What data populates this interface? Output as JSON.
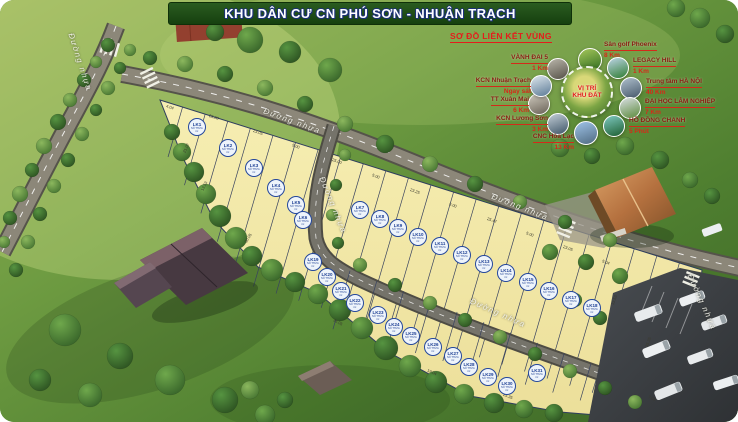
{
  "title": "KHU DÂN CƯ CN PHÚ SƠN - NHUẬN TRẠCH",
  "roads": {
    "label": "Đường nhựa",
    "instances": [
      {
        "x": 80,
        "y": 62,
        "rot": 72
      },
      {
        "x": 292,
        "y": 121,
        "rot": 20
      },
      {
        "x": 520,
        "y": 207,
        "rot": 21
      },
      {
        "x": 333,
        "y": 205,
        "rot": 68
      },
      {
        "x": 498,
        "y": 313,
        "rot": 24
      },
      {
        "x": 702,
        "y": 302,
        "rot": 66
      }
    ]
  },
  "inset": {
    "title": "SƠ ĐỒ LIÊN KẾT VÙNG",
    "center": {
      "line1": "VỊ TRÍ",
      "line2": "KHU ĐẤT",
      "cx": 587,
      "cy": 92,
      "r": 26
    },
    "items": [
      {
        "name": "Sân golf Phoenix",
        "distance": "8 Km",
        "cx": 590,
        "cy": 60,
        "r": 12,
        "lx": 604,
        "ly": 41,
        "lw": 86,
        "align": "left",
        "g1": "#a5c75a",
        "g2": "#2e6b1f",
        "icon": "golf-course-photo"
      },
      {
        "name": "LEGACY HILL",
        "distance": "1 Km",
        "cx": 618,
        "cy": 68,
        "r": 11,
        "lx": 633,
        "ly": 57,
        "lw": 72,
        "align": "left",
        "g1": "#bcd4e6",
        "g2": "#2f7d32",
        "icon": "legacy-hill-photo"
      },
      {
        "name": "Trung tâm HÀ NỘI",
        "distance": "40 Km",
        "cx": 631,
        "cy": 88,
        "r": 11,
        "lx": 646,
        "ly": 78,
        "lw": 88,
        "align": "left",
        "g1": "#aebfcc",
        "g2": "#46586a",
        "icon": "hanoi-skyline-photo"
      },
      {
        "name": "ĐẠI HỌC LÂM NGHIỆP",
        "distance": "7 Km",
        "cx": 630,
        "cy": 108,
        "r": 11,
        "lx": 645,
        "ly": 98,
        "lw": 95,
        "align": "left",
        "g1": "#d8dee2",
        "g2": "#5a8a3a",
        "icon": "university-photo"
      },
      {
        "name": "HỒ ĐỒNG CHANH",
        "distance": "5 Phút",
        "cx": 614,
        "cy": 126,
        "r": 11,
        "lx": 629,
        "ly": 117,
        "lw": 82,
        "align": "left",
        "g1": "#7ec8c0",
        "g2": "#1d5e30",
        "icon": "lake-photo"
      },
      {
        "name": "CNC Hòa Lạc",
        "distance": "13 Km",
        "cx": 586,
        "cy": 133,
        "r": 12,
        "lx": 508,
        "ly": 133,
        "lw": 66,
        "align": "right",
        "g1": "#9fc3e8",
        "g2": "#4f6a80",
        "icon": "hoa-lac-photo"
      },
      {
        "name": "KCN Lương Sơn",
        "distance": "3 Km",
        "cx": 558,
        "cy": 124,
        "r": 11,
        "lx": 478,
        "ly": 115,
        "lw": 70,
        "align": "right",
        "g1": "#c2cdd6",
        "g2": "#3f5668",
        "icon": "luong-son-industrial-photo"
      },
      {
        "name": "TT Xuân Mai",
        "distance": "6 Km",
        "cx": 539,
        "cy": 104,
        "r": 11,
        "lx": 459,
        "ly": 96,
        "lw": 70,
        "align": "right",
        "g1": "#cfcabe",
        "g2": "#6a6257",
        "icon": "xuan-mai-photo"
      },
      {
        "name": "KCN Nhuận Trạch",
        "distance": "Ngay sát",
        "cx": 541,
        "cy": 86,
        "r": 11,
        "lx": 461,
        "ly": 77,
        "lw": 70,
        "align": "right",
        "g1": "#dde6ec",
        "g2": "#5b7a96",
        "icon": "nhuan-trach-industrial-photo"
      },
      {
        "name": "VÀNH ĐAI 5",
        "distance": "1 Km",
        "cx": 558,
        "cy": 69,
        "r": 11,
        "lx": 478,
        "ly": 54,
        "lw": 70,
        "align": "right",
        "g1": "#b9b5aa",
        "g2": "#565248",
        "icon": "ring-road-5-photo"
      }
    ]
  },
  "plot_detail": {
    "line1": "SỐ THỬA",
    "line2": "m²"
  },
  "plots": [
    {
      "label": "LK1",
      "x": 197,
      "y": 127
    },
    {
      "label": "LK2",
      "x": 228,
      "y": 148
    },
    {
      "label": "LK3",
      "x": 254,
      "y": 168
    },
    {
      "label": "LK4",
      "x": 276,
      "y": 188
    },
    {
      "label": "LK5",
      "x": 296,
      "y": 205
    },
    {
      "label": "LK6",
      "x": 303,
      "y": 220
    },
    {
      "label": "LK7",
      "x": 360,
      "y": 210
    },
    {
      "label": "LK8",
      "x": 380,
      "y": 219
    },
    {
      "label": "LK9",
      "x": 398,
      "y": 228
    },
    {
      "label": "LK10",
      "x": 418,
      "y": 237
    },
    {
      "label": "LK11",
      "x": 440,
      "y": 246
    },
    {
      "label": "LK12",
      "x": 462,
      "y": 255
    },
    {
      "label": "LK13",
      "x": 484,
      "y": 264
    },
    {
      "label": "LK14",
      "x": 506,
      "y": 273
    },
    {
      "label": "LK15",
      "x": 528,
      "y": 282
    },
    {
      "label": "LK16",
      "x": 549,
      "y": 291
    },
    {
      "label": "LK17",
      "x": 571,
      "y": 300
    },
    {
      "label": "LK18",
      "x": 592,
      "y": 308
    },
    {
      "label": "LK19",
      "x": 313,
      "y": 262
    },
    {
      "label": "LK20",
      "x": 327,
      "y": 277
    },
    {
      "label": "LK21",
      "x": 341,
      "y": 291
    },
    {
      "label": "LK22",
      "x": 355,
      "y": 303
    },
    {
      "label": "LK23",
      "x": 378,
      "y": 315
    },
    {
      "label": "LK24",
      "x": 394,
      "y": 327
    },
    {
      "label": "LK25",
      "x": 411,
      "y": 336
    },
    {
      "label": "LK26",
      "x": 433,
      "y": 347
    },
    {
      "label": "LK27",
      "x": 453,
      "y": 356
    },
    {
      "label": "LK28",
      "x": 469,
      "y": 367
    },
    {
      "label": "LK29",
      "x": 488,
      "y": 377
    },
    {
      "label": "LK30",
      "x": 507,
      "y": 386
    },
    {
      "label": "LK31",
      "x": 537,
      "y": 373
    }
  ],
  "dims": [
    {
      "t": "4.04",
      "x": 170,
      "y": 107,
      "r": 18
    },
    {
      "t": "25.00",
      "x": 214,
      "y": 117,
      "r": 18
    },
    {
      "t": "23.05",
      "x": 258,
      "y": 132,
      "r": 19
    },
    {
      "t": "5.00",
      "x": 296,
      "y": 146,
      "r": 20
    },
    {
      "t": "25.00",
      "x": 337,
      "y": 161,
      "r": 20
    },
    {
      "t": "5.00",
      "x": 376,
      "y": 176,
      "r": 20
    },
    {
      "t": "23.25",
      "x": 415,
      "y": 191,
      "r": 20
    },
    {
      "t": "5.00",
      "x": 453,
      "y": 205,
      "r": 20
    },
    {
      "t": "25.47",
      "x": 492,
      "y": 220,
      "r": 20
    },
    {
      "t": "5.00",
      "x": 530,
      "y": 234,
      "r": 20
    },
    {
      "t": "23.05",
      "x": 568,
      "y": 248,
      "r": 20
    },
    {
      "t": "5.04",
      "x": 606,
      "y": 262,
      "r": 20
    },
    {
      "t": "21.07",
      "x": 186,
      "y": 148,
      "r": -65
    },
    {
      "t": "13.53",
      "x": 204,
      "y": 186,
      "r": -65
    },
    {
      "t": "30.05",
      "x": 248,
      "y": 238,
      "r": -60
    },
    {
      "t": "33.53",
      "x": 614,
      "y": 300,
      "r": -70
    },
    {
      "t": "35.35",
      "x": 648,
      "y": 342,
      "r": -70
    },
    {
      "t": "25.35",
      "x": 508,
      "y": 396,
      "r": 22
    },
    {
      "t": "19.04",
      "x": 432,
      "y": 372,
      "r": 24
    },
    {
      "t": "35.05",
      "x": 338,
      "y": 322,
      "r": 28
    },
    {
      "t": "7.01",
      "x": 652,
      "y": 398,
      "r": 22
    }
  ],
  "colors": {
    "banner": "#1f4d18",
    "banner_text": "#ffffff",
    "plot_fill": "#f3eaa8",
    "marker_border": "#24479c",
    "marker_text": "#1d3f94",
    "inset_accent": "#e41c1c",
    "road": "#8c8779",
    "grass": "#5d8a37"
  }
}
